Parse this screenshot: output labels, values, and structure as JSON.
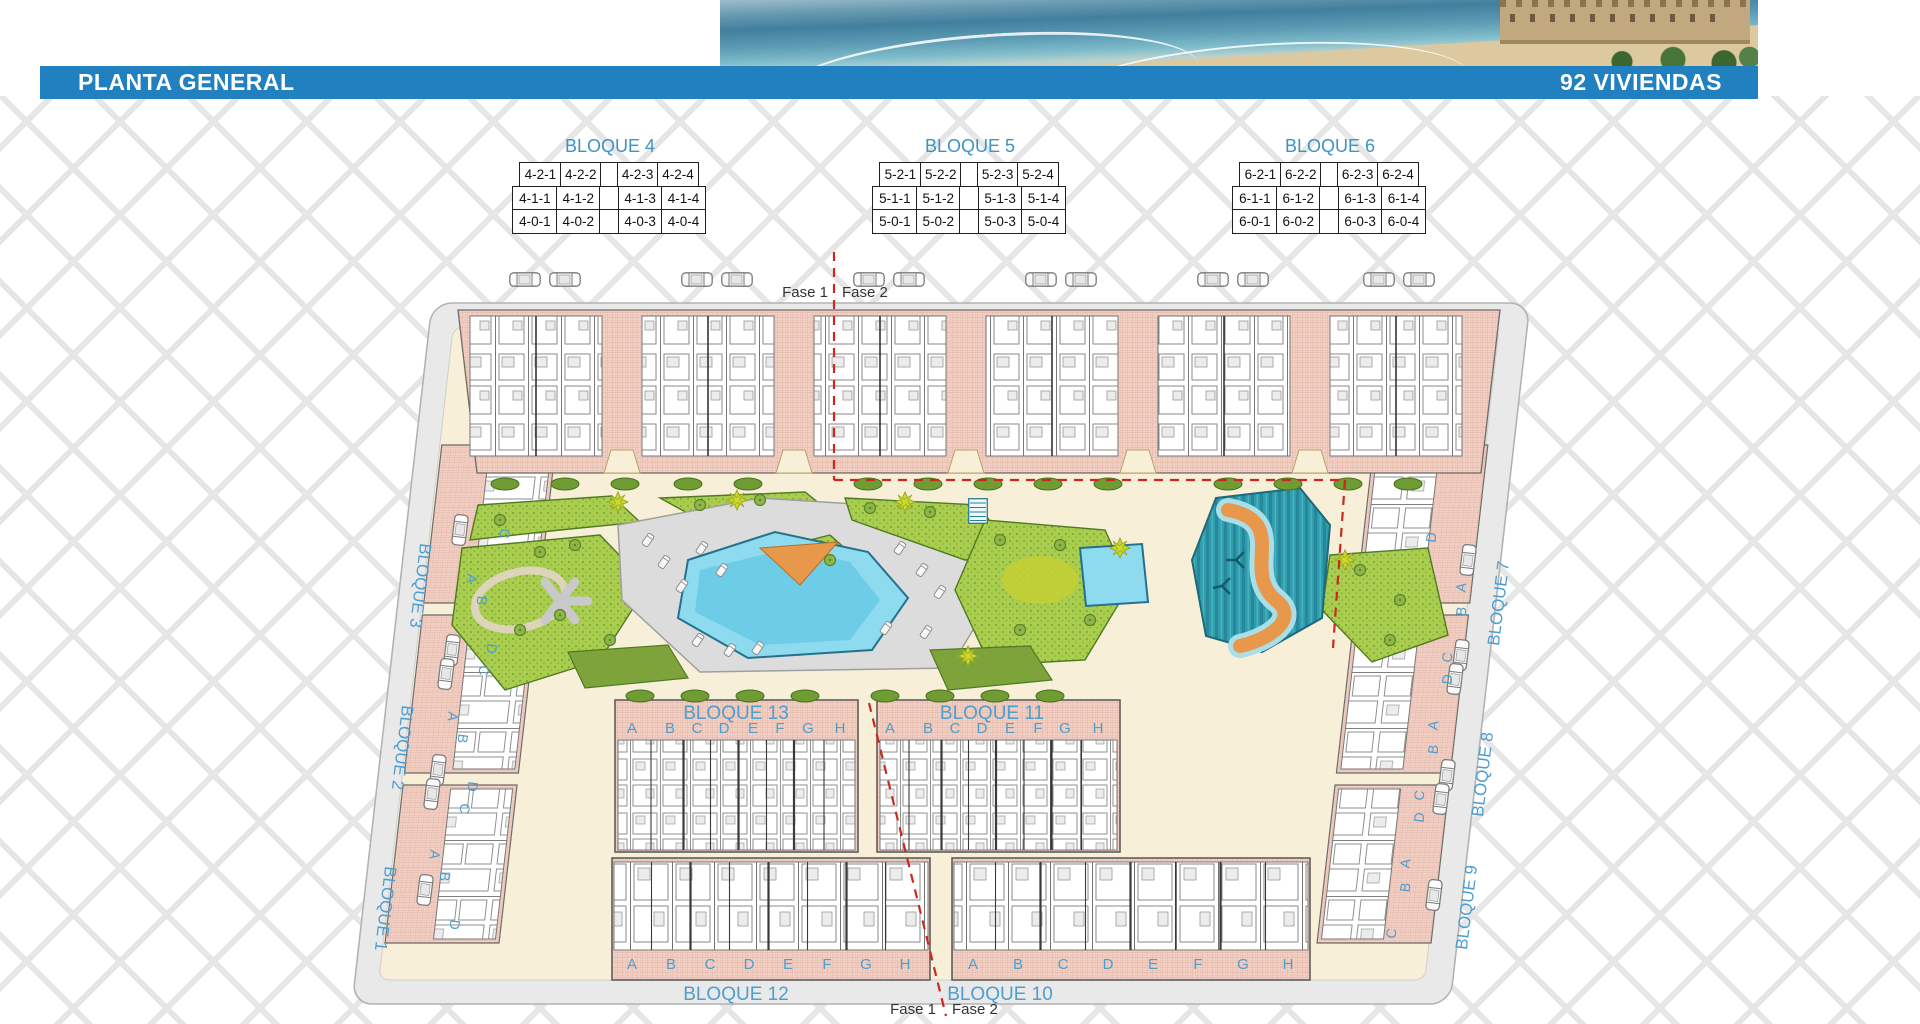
{
  "header": {
    "title": "PLANTA GENERAL",
    "units_badge": "92 VIVIENDAS"
  },
  "legend_tables": [
    {
      "title": "BLOQUE 4",
      "rows": [
        [
          "4-2-1",
          "4-2-2",
          "",
          "4-2-3",
          "4-2-4"
        ],
        [
          "4-1-1",
          "4-1-2",
          "",
          "4-1-3",
          "4-1-4"
        ],
        [
          "4-0-1",
          "4-0-2",
          "",
          "4-0-3",
          "4-0-4"
        ]
      ]
    },
    {
      "title": "BLOQUE 5",
      "rows": [
        [
          "5-2-1",
          "5-2-2",
          "",
          "5-2-3",
          "5-2-4"
        ],
        [
          "5-1-1",
          "5-1-2",
          "",
          "5-1-3",
          "5-1-4"
        ],
        [
          "5-0-1",
          "5-0-2",
          "",
          "5-0-3",
          "5-0-4"
        ]
      ]
    },
    {
      "title": "BLOQUE 6",
      "rows": [
        [
          "6-2-1",
          "6-2-2",
          "",
          "6-2-3",
          "6-2-4"
        ],
        [
          "6-1-1",
          "6-1-2",
          "",
          "6-1-3",
          "6-1-4"
        ],
        [
          "6-0-1",
          "6-0-2",
          "",
          "6-0-3",
          "6-0-4"
        ]
      ]
    }
  ],
  "phase_labels": {
    "fase1": "Fase 1",
    "fase2": "Fase 2"
  },
  "plan": {
    "block_labels": {
      "b1": "BLOQUE 1",
      "b2": "BLOQUE 2",
      "b3": "BLOQUE 3",
      "b7": "BLOQUE 7",
      "b8": "BLOQUE 8",
      "b9": "BLOQUE 9",
      "b10": "BLOQUE 10",
      "b11": "BLOQUE 11",
      "b12": "BLOQUE 12",
      "b13": "BLOQUE 13"
    },
    "row_letters": [
      "A",
      "B",
      "C",
      "D",
      "E",
      "F",
      "G",
      "H"
    ],
    "side_letters": [
      "A",
      "B",
      "C",
      "D"
    ],
    "colors": {
      "accent_blue": "#2180c0",
      "table_title_blue": "#3d93c4",
      "plan_letter_blue": "#4e9ecf",
      "building_pink": "#f3d1c5",
      "pool_blue": "#8edbef",
      "river_teal": "#2f9dae",
      "path_orange": "#e8984a",
      "phase_red": "#c82a21",
      "garden_green": "#a9cd4e",
      "road_gray": "#e9e9e9",
      "ground_cream": "#f8efd8"
    }
  }
}
